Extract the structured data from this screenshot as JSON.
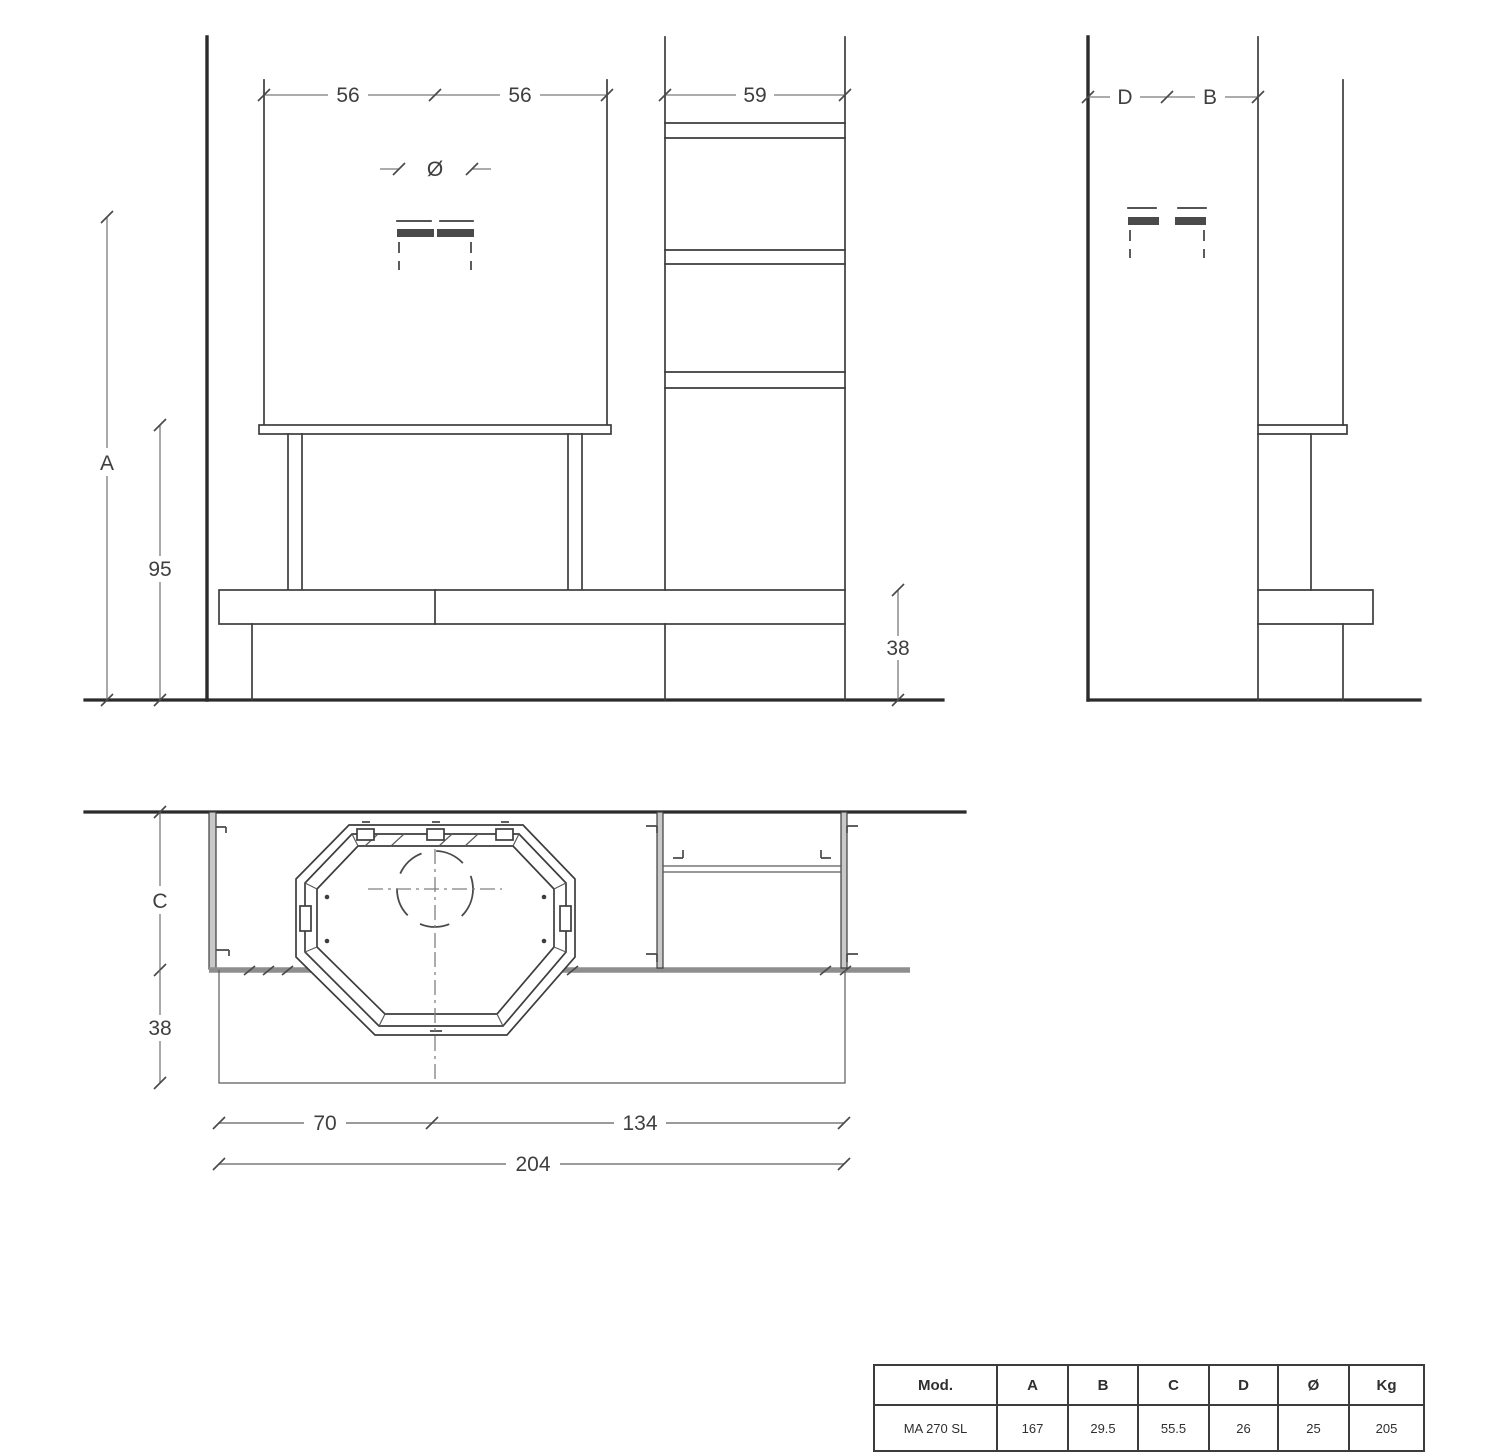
{
  "drawing_title": "Fireplace cladding dimensional drawing",
  "front_view": {
    "dim_hood_left_half": "56",
    "dim_hood_right_half": "56",
    "dim_shelf_column_width": "59",
    "flue_diameter_symbol": "Ø",
    "dim_total_height": "A",
    "dim_hood_bottom_height": "95",
    "dim_bench_height": "38"
  },
  "side_view": {
    "dim_depth_back": "D",
    "dim_depth_front": "B"
  },
  "plan_view": {
    "dim_top_depth": "C",
    "dim_bench_front_depth": "38",
    "dim_left_span": "70",
    "dim_right_span": "134",
    "dim_total_span": "204"
  },
  "spec_table": {
    "headers": [
      "Mod.",
      "A",
      "B",
      "C",
      "D",
      "Ø",
      "Kg"
    ],
    "row": [
      "MA 270 SL",
      "167",
      "29.5",
      "55.5",
      "26",
      "25",
      "205"
    ]
  },
  "colors": {
    "line": "#3d3d3d",
    "wall": "#2b2b2b",
    "dimension": "#7b7b7b",
    "gray_edge": "#8e8e8e",
    "background": "#ffffff"
  }
}
